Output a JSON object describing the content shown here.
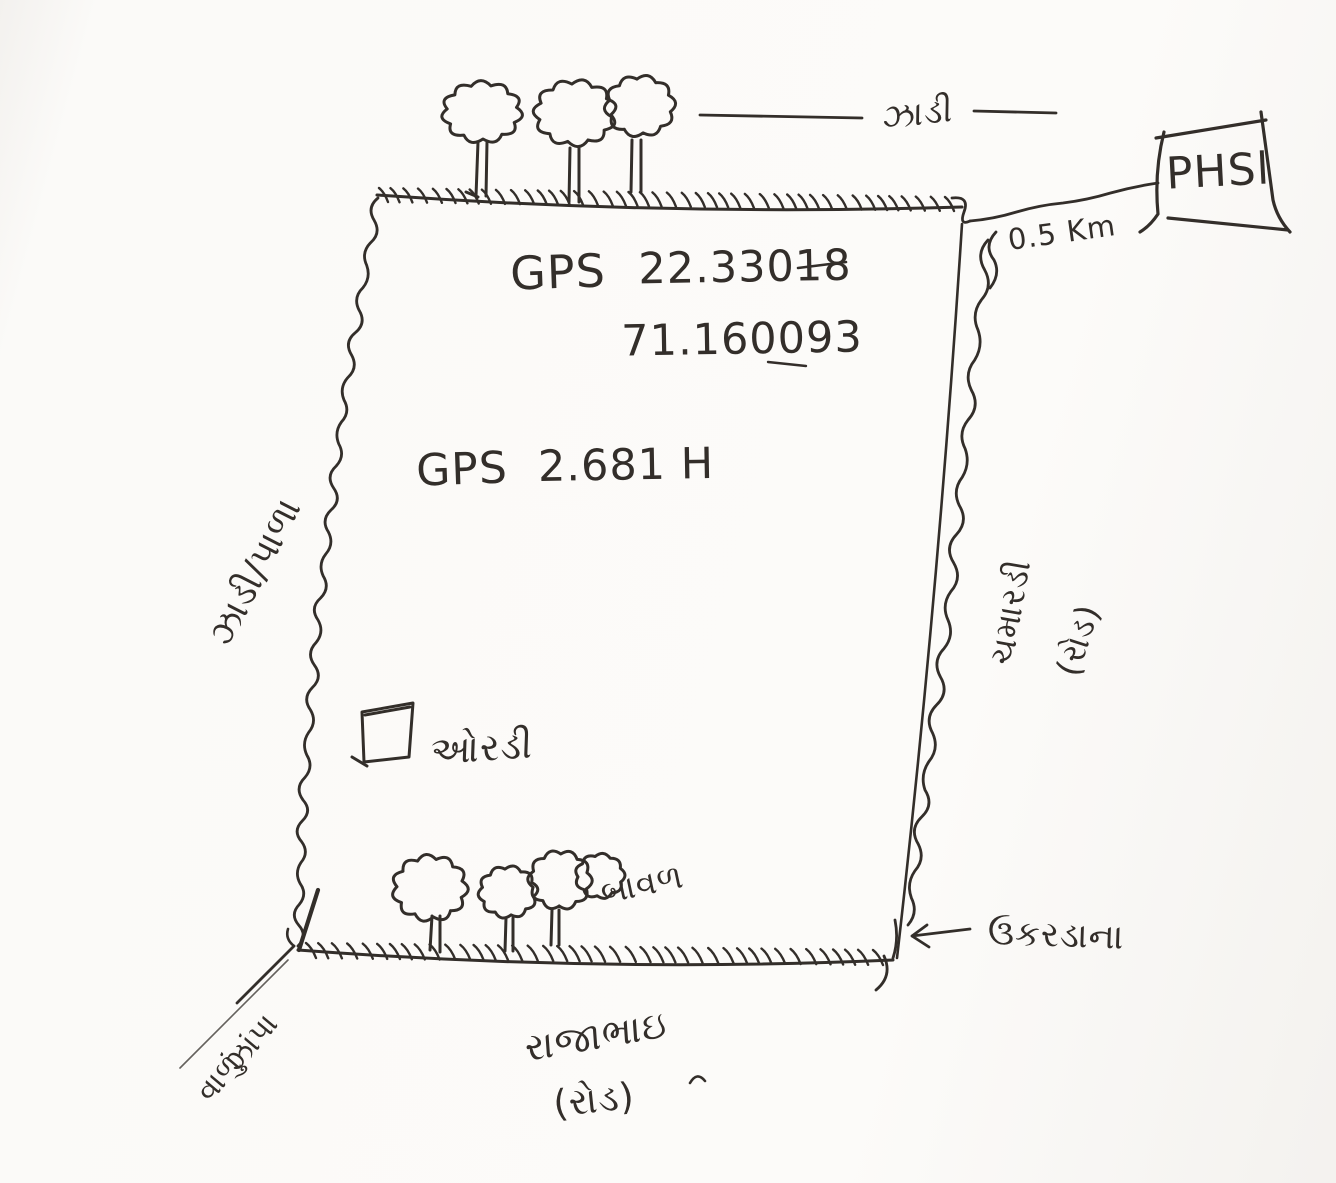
{
  "colors": {
    "ink": "#332e2a",
    "paper": "#fcfbf9"
  },
  "plot": {
    "gps_label": "GPS",
    "latitude": "22.33018",
    "longitude": "71.160093",
    "area_label": "GPS",
    "area_value": "2.681 H"
  },
  "annotations": {
    "top_trees": "ઝાડી",
    "phs_box": "PHSl",
    "distance": "0.5 Km",
    "left_edge": "ઝાડી/પાળા",
    "hut": "ઓરડી",
    "bottom_trees": "બાવળ",
    "right_edge_name": "ચમારડી",
    "right_edge_type": "(રોડ)",
    "corner_note": "ઉકરડાના",
    "bottom_edge_name": "રાજાભાઇ",
    "bottom_edge_type": "(રોડ)",
    "gate_line1": "ઝાંપા",
    "gate_line2": "વાળું"
  }
}
